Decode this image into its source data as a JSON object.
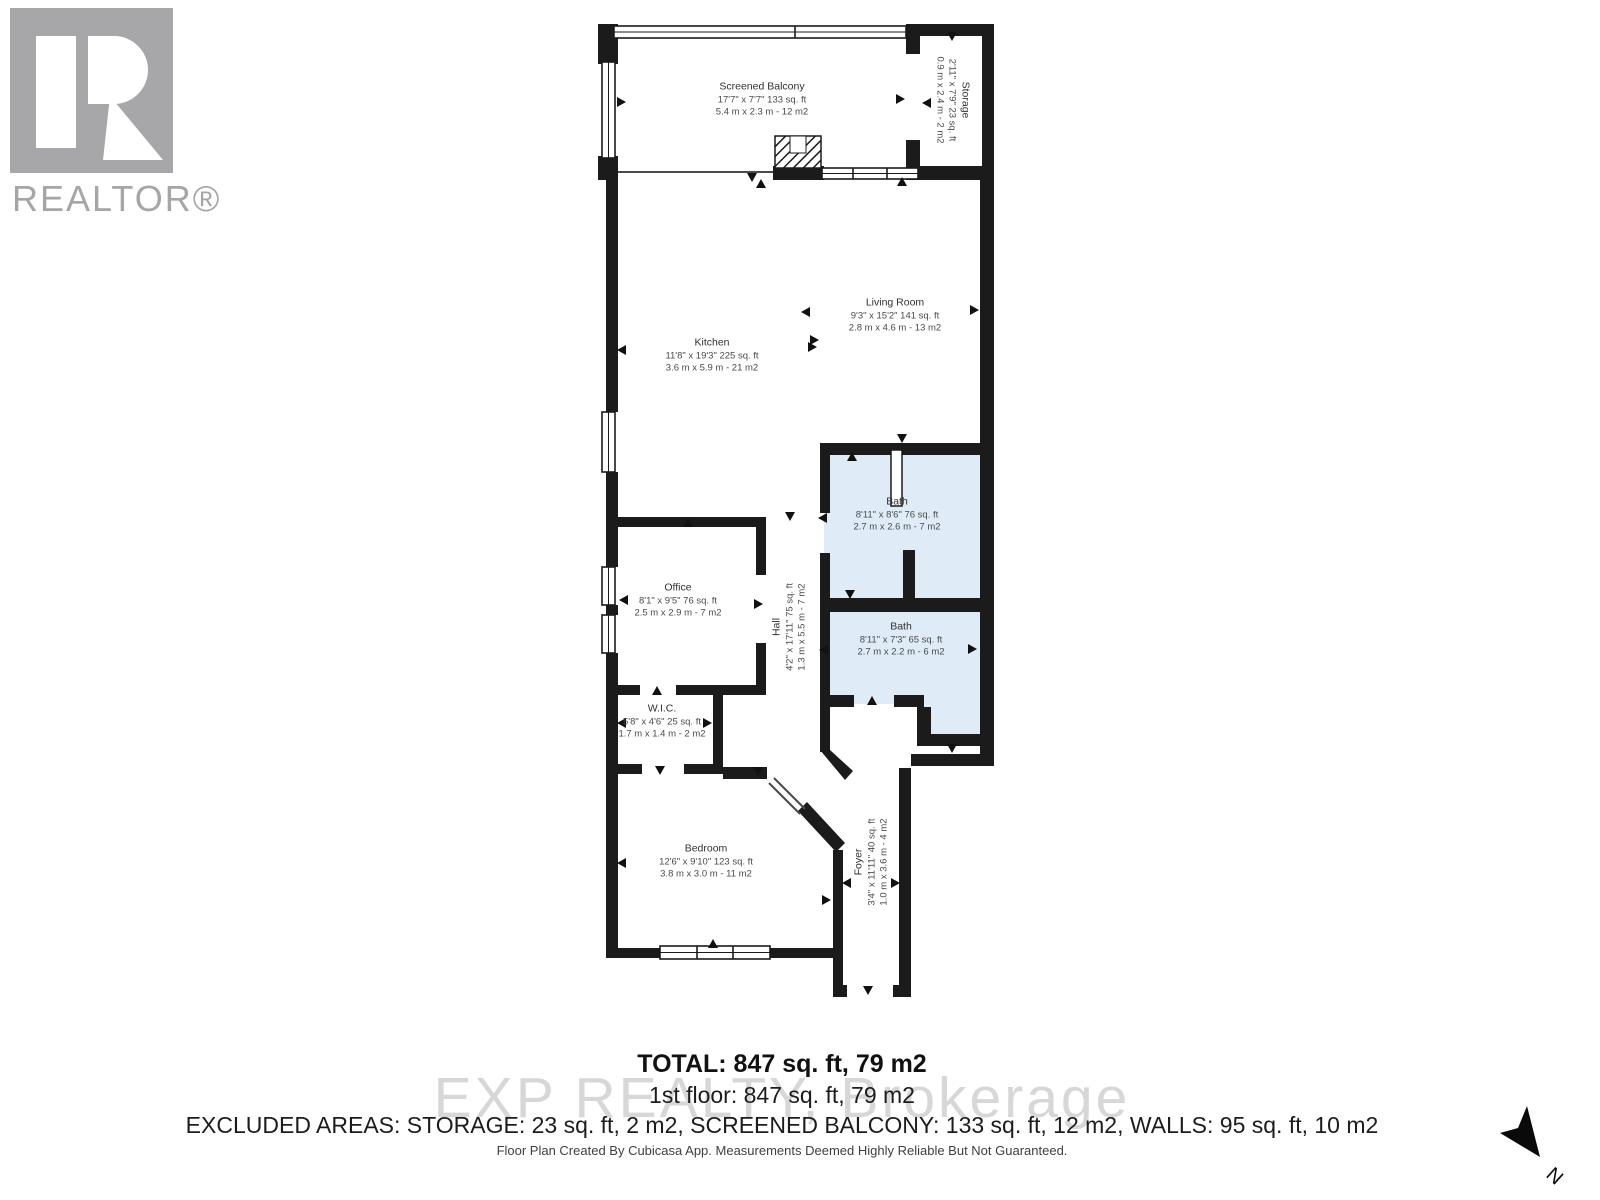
{
  "branding": {
    "realtor_logo_text": "REALTOR®",
    "watermark": "EXP REALTY, Brokerage"
  },
  "rooms": [
    {
      "id": "screened-balcony",
      "name": "Screened Balcony",
      "dims_ft": "17'7\" x 7'7\" 133 sq. ft",
      "dims_m": "5.4 m x 2.3 m - 12 m2"
    },
    {
      "id": "storage",
      "name": "Storage",
      "dims_ft": "2'11\" x 7'9\" 23 sq. ft",
      "dims_m": "0.9 m x 2.4 m - 2 m2"
    },
    {
      "id": "kitchen",
      "name": "Kitchen",
      "dims_ft": "11'8\" x 19'3\" 225 sq. ft",
      "dims_m": "3.6 m x 5.9 m - 21 m2"
    },
    {
      "id": "living-room",
      "name": "Living Room",
      "dims_ft": "9'3\" x 15'2\" 141 sq. ft",
      "dims_m": "2.8 m x 4.6 m - 13 m2"
    },
    {
      "id": "bath-upper",
      "name": "Bath",
      "dims_ft": "8'11\" x 8'6\" 76 sq. ft",
      "dims_m": "2.7 m x 2.6 m - 7 m2"
    },
    {
      "id": "office",
      "name": "Office",
      "dims_ft": "8'1\" x 9'5\" 76 sq. ft",
      "dims_m": "2.5 m x 2.9 m - 7 m2"
    },
    {
      "id": "hall",
      "name": "Hall",
      "dims_ft": "4'2\" x 17'11\" 75 sq. ft",
      "dims_m": "1.3 m x 5.5 m - 7 m2"
    },
    {
      "id": "bath-lower",
      "name": "Bath",
      "dims_ft": "8'11\" x 7'3\" 65 sq. ft",
      "dims_m": "2.7 m x 2.2 m - 6 m2"
    },
    {
      "id": "wic",
      "name": "W.I.C.",
      "dims_ft": "5'8\" x 4'6\" 25 sq. ft",
      "dims_m": "1.7 m x 1.4 m - 2 m2"
    },
    {
      "id": "bedroom",
      "name": "Bedroom",
      "dims_ft": "12'6\" x 9'10\" 123 sq. ft",
      "dims_m": "3.8 m x 3.0 m - 11 m2"
    },
    {
      "id": "foyer",
      "name": "Foyer",
      "dims_ft": "3'4\" x 11'11\" 40 sq. ft",
      "dims_m": "1.0 m x 3.6 m - 4 m2"
    }
  ],
  "summary": {
    "total": "TOTAL: 847 sq. ft, 79 m2",
    "floor": "1st floor: 847 sq. ft, 79 m2",
    "excluded": "EXCLUDED AREAS: STORAGE: 23 sq. ft, 2 m2, SCREENED BALCONY: 133 sq. ft, 12 m2, WALLS: 95 sq. ft, 10 m2",
    "disclaimer": "Floor Plan Created By Cubicasa App. Measurements Deemed Highly Reliable But Not Guaranteed."
  },
  "compass": {
    "label": "N"
  },
  "colors": {
    "wall": "#1b1b1b",
    "bath_fill": "#dfecf8",
    "logo_gray": "#a7a7a9",
    "watermark_gray": "#d7d7d7"
  }
}
